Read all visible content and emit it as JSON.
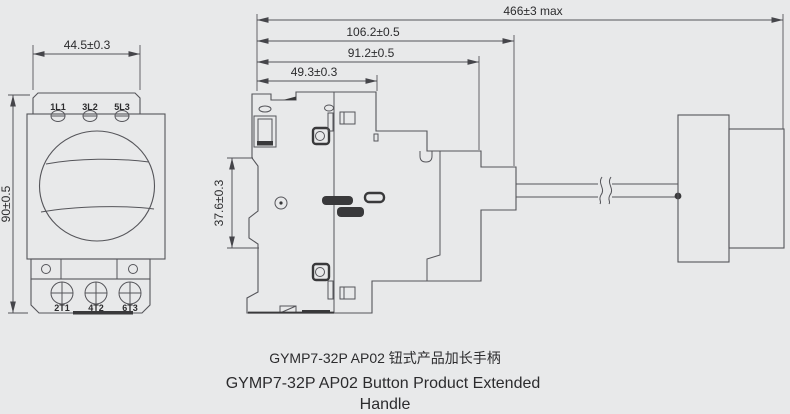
{
  "theme": {
    "background": "#e8e9ea",
    "line_color": "#55555a",
    "dark_feature_color": "#39393b",
    "text_color": "#2c2c2e"
  },
  "front_view": {
    "width_dimension": "44.5±0.3",
    "height_dimension": "90±0.5",
    "top_terminals": [
      "1L1",
      "3L2",
      "5L3"
    ],
    "bottom_terminals": [
      "2T1",
      "4T2",
      "6T3"
    ]
  },
  "side_view": {
    "total_length_dimension": "466±3 max",
    "body_with_adapter_dimension": "106.2±0.5",
    "body_depth_dimension": "91.2±0.5",
    "front_depth_dimension": "49.3±0.3",
    "din_channel_dimension": "37.6±0.3"
  },
  "caption": {
    "line1_zh": "GYMP7-32P AP02 钮式产品加长手柄",
    "line2_en": "GYMP7-32P AP02 Button Product Extended",
    "line3_en": "Handle"
  }
}
